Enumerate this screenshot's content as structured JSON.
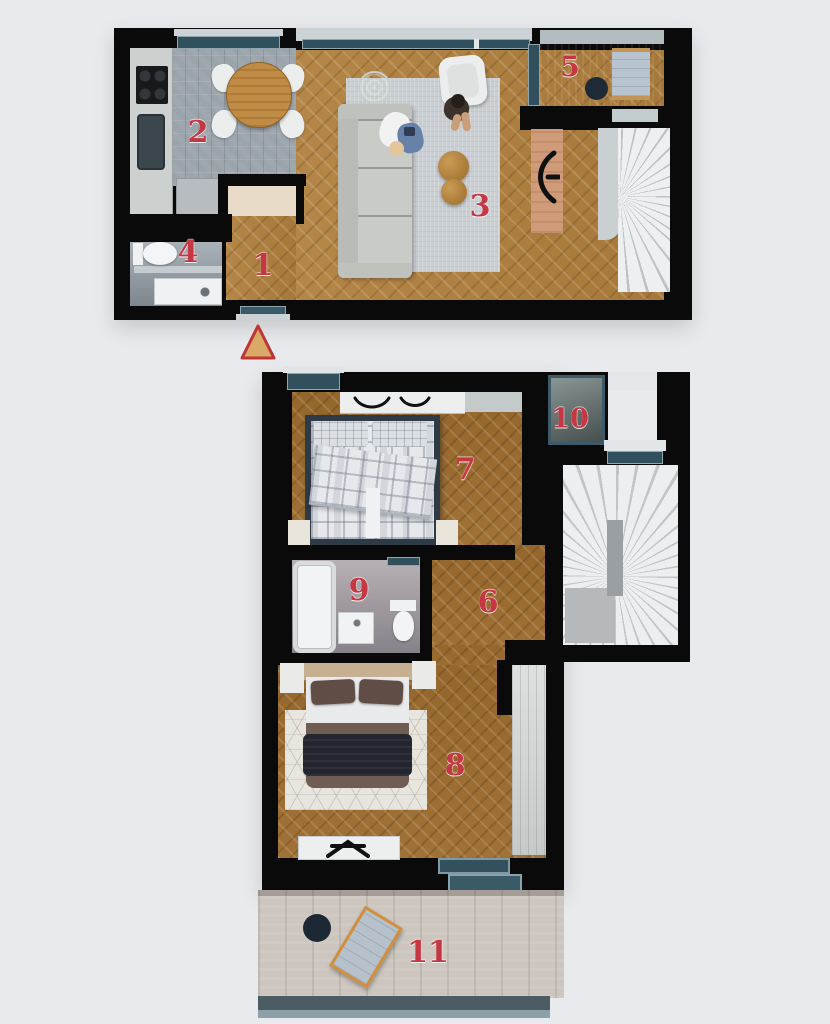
{
  "plan": {
    "entrance_marker": {
      "shape": "triangle",
      "fill": "#d9a967",
      "stroke": "#c13434"
    },
    "levels": [
      {
        "id": "upper-level",
        "rooms": [
          {
            "number": "1"
          },
          {
            "number": "2"
          },
          {
            "number": "3"
          },
          {
            "number": "4"
          },
          {
            "number": "5"
          }
        ]
      },
      {
        "id": "lower-level",
        "rooms": [
          {
            "number": "6"
          },
          {
            "number": "7"
          },
          {
            "number": "8"
          },
          {
            "number": "9"
          },
          {
            "number": "10"
          },
          {
            "number": "11"
          }
        ]
      }
    ]
  },
  "colors": {
    "background": "#e8eaed",
    "walls": "#0a0a0b",
    "room_number": "#c43743",
    "wood_upper": "#b0803e",
    "wood_lower": "#9c6c2f",
    "kitchen_tile": "#9ba3ab",
    "window_glass": "#31505e",
    "stairs": "#edeff0",
    "deck": "#ccc6bf"
  }
}
